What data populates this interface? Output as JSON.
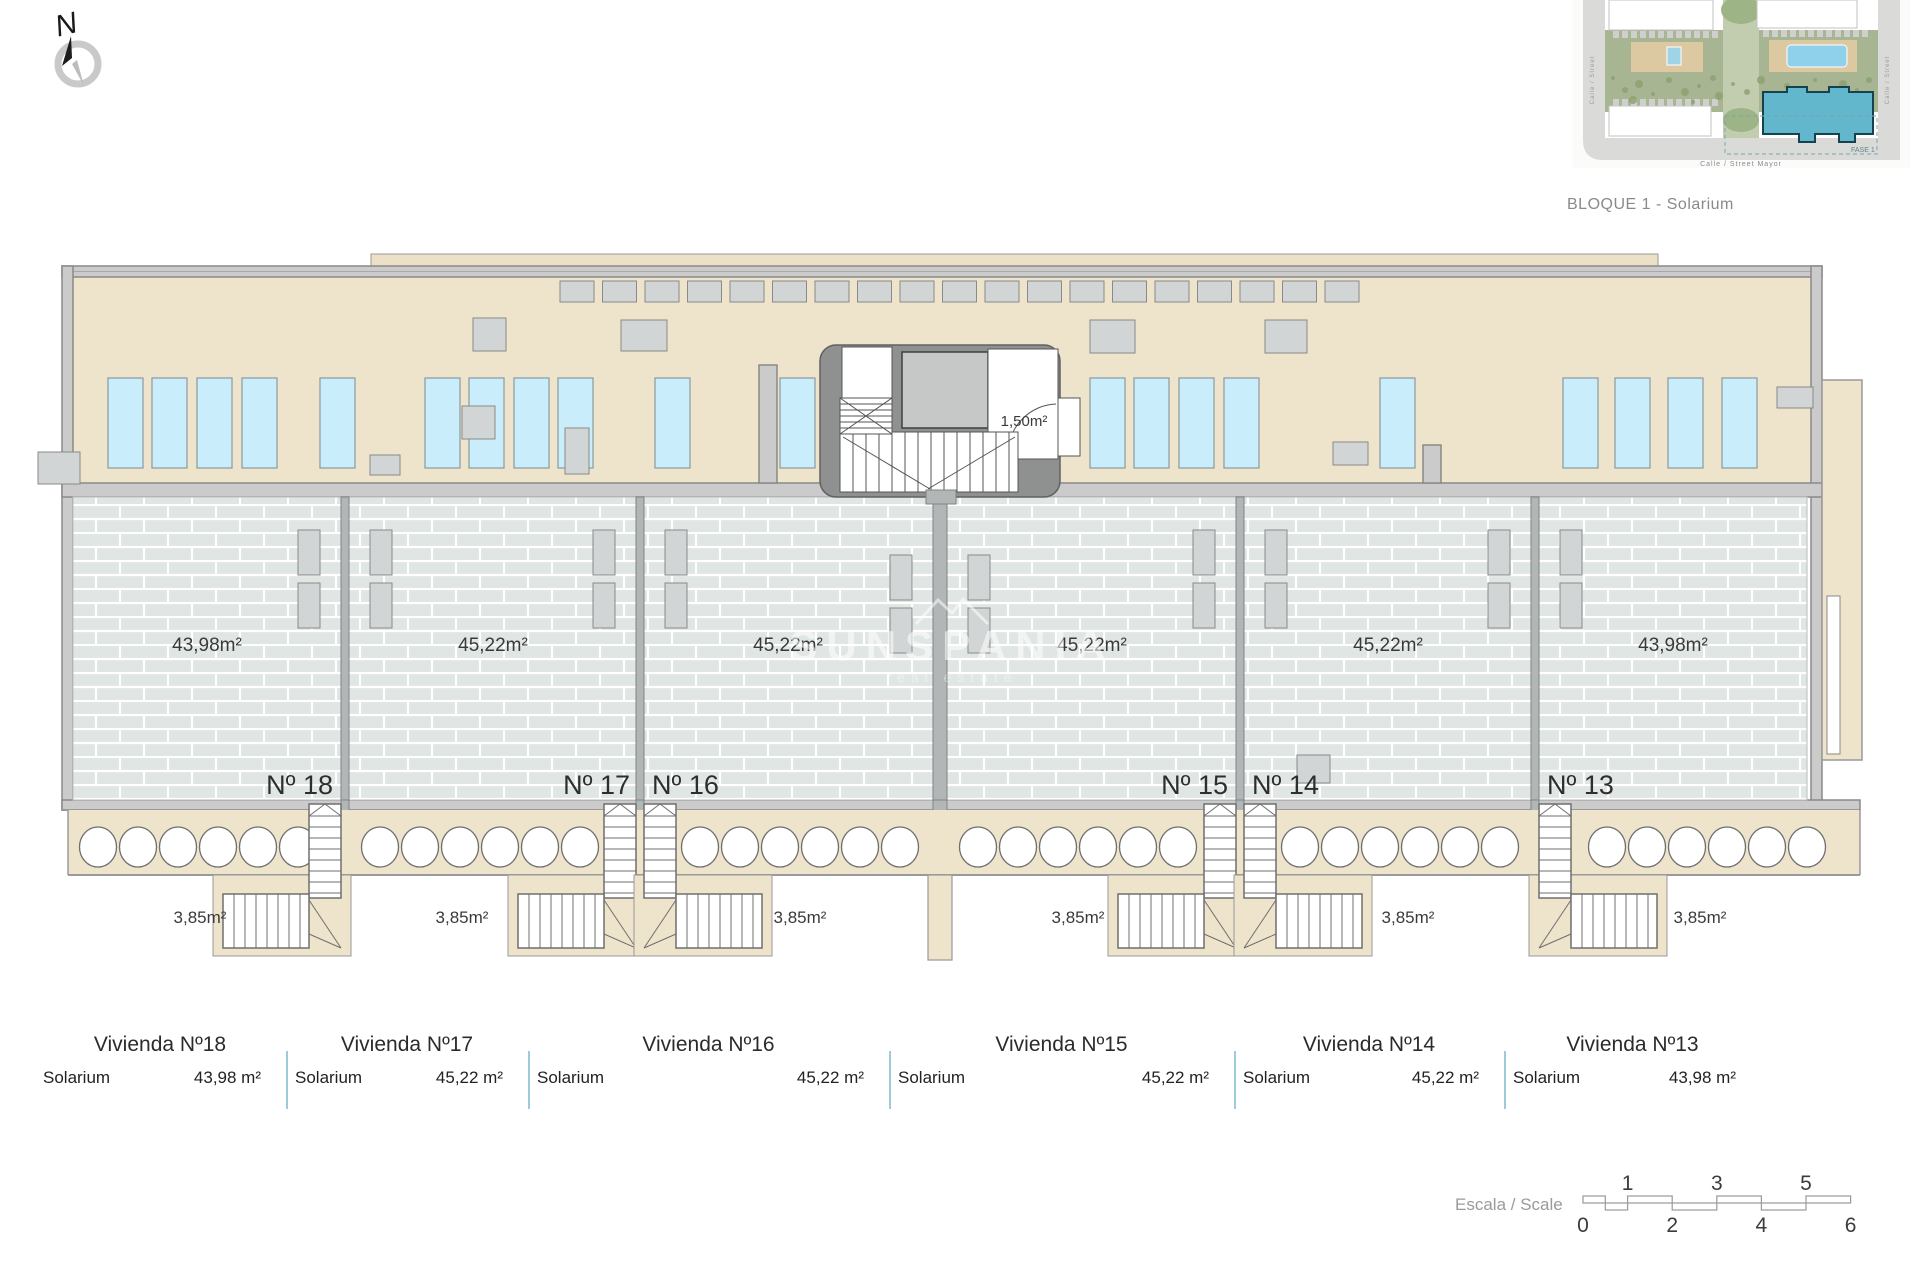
{
  "compass": {
    "label": "N"
  },
  "site_plan": {
    "caption": "BLOQUE 1 - Solarium",
    "fase_label": "FASE 1",
    "street_bottom": "Calle / Street Mayor",
    "street_left": "Calle / Street",
    "street_right": "Calle / Street"
  },
  "watermark": {
    "name": "SUNSPANIA",
    "tagline": "real estate"
  },
  "core": {
    "wc_area": "1,50m²"
  },
  "units": [
    {
      "number": "Nº 18",
      "area": "43,98m²",
      "stair_area": "3,85m²",
      "vivienda": "Vivienda Nº18",
      "row_label": "Solarium",
      "row_value": "43,98 m²"
    },
    {
      "number": "Nº 17",
      "area": "45,22m²",
      "stair_area": "3,85m²",
      "vivienda": "Vivienda Nº17",
      "row_label": "Solarium",
      "row_value": "45,22 m²"
    },
    {
      "number": "Nº 16",
      "area": "45,22m²",
      "stair_area": "3,85m²",
      "vivienda": "Vivienda Nº16",
      "row_label": "Solarium",
      "row_value": "45,22 m²"
    },
    {
      "number": "Nº 15",
      "area": "45,22m²",
      "stair_area": "3,85m²",
      "vivienda": "Vivienda Nº15",
      "row_label": "Solarium",
      "row_value": "45,22 m²"
    },
    {
      "number": "Nº 14",
      "area": "45,22m²",
      "stair_area": "3,85m²",
      "vivienda": "Vivienda Nº14",
      "row_label": "Solarium",
      "row_value": "45,22 m²"
    },
    {
      "number": "Nº 13",
      "area": "43,98m²",
      "stair_area": "3,85m²",
      "vivienda": "Vivienda Nº13",
      "row_label": "Solarium",
      "row_value": "43,98 m²"
    }
  ],
  "scale": {
    "label": "Escala / Scale",
    "top_ticks": [
      "1",
      "3",
      "5"
    ],
    "bottom_ticks": [
      "0",
      "2",
      "4",
      "6"
    ]
  },
  "colors": {
    "beige": "#eee3cb",
    "roof_strip": "#ece0c6",
    "wall_fill": "#cbcbcb",
    "wall_line": "#8a8a8a",
    "tile": "#e0e6e3",
    "divider": "#b2b6b6",
    "sunbed": "#c9edfa",
    "planter": "#d2d5d6",
    "core": "#8f9191",
    "table_divider": "#9fcbd6",
    "bloque_teal": "#62b7cc",
    "text": "#3a3a3a"
  }
}
